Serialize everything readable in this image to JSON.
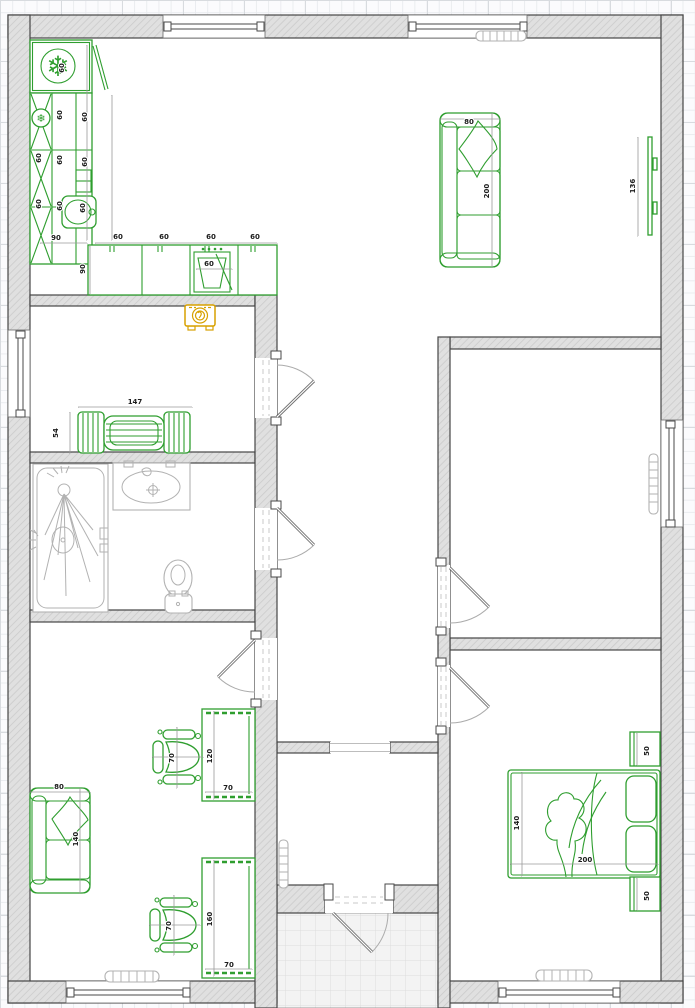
{
  "canvas": {
    "width": 695,
    "height": 1008,
    "description": "2D floor plan editor canvas"
  },
  "colors": {
    "furniture_green": "#2f9e2f",
    "selected_amber": "#d7a100",
    "wall_fill": "#e0e0e0",
    "wall_hatch": "#cbcbcb",
    "wall_edge": "#454545",
    "fixture_gray": "#b2b2b2",
    "dimension_line": "#9a9a9a",
    "dimension_text": "#1c1c1c",
    "grid_line": "#eaecef",
    "grid_major": "#d8dbdf",
    "paper": "#fbfbfd",
    "tile_fill": "#f3f3f3",
    "tile_line": "#dcdcdc"
  },
  "furniture_icons": [
    "refrigerator-icon",
    "kitchen-cabinet-icon",
    "kitchen-sink-icon",
    "cooktop-icon",
    "washing-machine-icon",
    "bench-seat-icon",
    "sofa-icon",
    "tv-icon",
    "shower-icon",
    "washbasin-icon",
    "toilet-icon",
    "office-chair-icon",
    "desk-icon",
    "loveseat-icon",
    "double-bed-icon",
    "nightstand-icon",
    "radiator-icon"
  ],
  "dimension_labels": [
    {
      "text": "60",
      "x": 64,
      "y": 68,
      "rot": -90
    },
    {
      "text": "60",
      "x": 62,
      "y": 115,
      "rot": -90
    },
    {
      "text": "60",
      "x": 87,
      "y": 117,
      "rot": -90
    },
    {
      "text": "60",
      "x": 41,
      "y": 158,
      "rot": -90
    },
    {
      "text": "60",
      "x": 62,
      "y": 160,
      "rot": -90
    },
    {
      "text": "60",
      "x": 87,
      "y": 162,
      "rot": -90
    },
    {
      "text": "60",
      "x": 41,
      "y": 204,
      "rot": -90
    },
    {
      "text": "60",
      "x": 62,
      "y": 206,
      "rot": -90
    },
    {
      "text": "60",
      "x": 85,
      "y": 208,
      "rot": -90
    },
    {
      "text": "90",
      "x": 85,
      "y": 269,
      "rot": -90
    },
    {
      "text": "90",
      "x": 56,
      "y": 240,
      "rot": 0
    },
    {
      "text": "60",
      "x": 118,
      "y": 239,
      "rot": 0
    },
    {
      "text": "60",
      "x": 164,
      "y": 239,
      "rot": 0
    },
    {
      "text": "60",
      "x": 211,
      "y": 239,
      "rot": 0
    },
    {
      "text": "60",
      "x": 255,
      "y": 239,
      "rot": 0
    },
    {
      "text": "60",
      "x": 209,
      "y": 266,
      "rot": 0
    },
    {
      "text": "147",
      "x": 135,
      "y": 404,
      "rot": 0
    },
    {
      "text": "54",
      "x": 58,
      "y": 433,
      "rot": -90
    },
    {
      "text": "80",
      "x": 469,
      "y": 124,
      "rot": 0
    },
    {
      "text": "200",
      "x": 489,
      "y": 191,
      "rot": -90
    },
    {
      "text": "136",
      "x": 635,
      "y": 186,
      "rot": -90
    },
    {
      "text": "70",
      "x": 174,
      "y": 758,
      "rot": -90
    },
    {
      "text": "120",
      "x": 212,
      "y": 756,
      "rot": -90
    },
    {
      "text": "70",
      "x": 228,
      "y": 790,
      "rot": 0
    },
    {
      "text": "80",
      "x": 59,
      "y": 789,
      "rot": 0
    },
    {
      "text": "140",
      "x": 78,
      "y": 839,
      "rot": -90
    },
    {
      "text": "70",
      "x": 171,
      "y": 926,
      "rot": -90
    },
    {
      "text": "160",
      "x": 212,
      "y": 919,
      "rot": -90
    },
    {
      "text": "70",
      "x": 229,
      "y": 967,
      "rot": 0
    },
    {
      "text": "140",
      "x": 519,
      "y": 823,
      "rot": -90
    },
    {
      "text": "200",
      "x": 585,
      "y": 862,
      "rot": 0
    },
    {
      "text": "50",
      "x": 649,
      "y": 751,
      "rot": -90
    },
    {
      "text": "50",
      "x": 649,
      "y": 896,
      "rot": -90
    }
  ]
}
